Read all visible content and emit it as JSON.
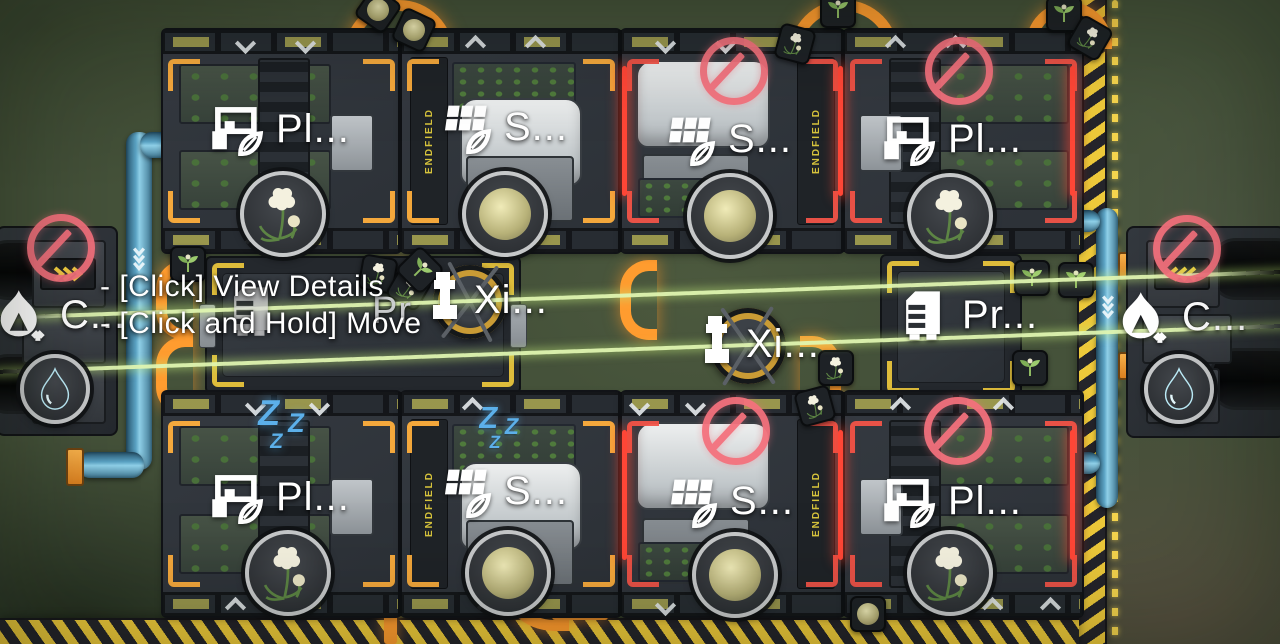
{
  "hud": {
    "tooltip": [
      "- [Click] View Details",
      "- [Click and Hold] Move"
    ],
    "sleep_glyph": "Z"
  },
  "world": {
    "brand_text": "ENDFIELD"
  },
  "buildings": [
    {
      "type": "planter",
      "label": "Pl...",
      "status": "active",
      "output": "flower",
      "position": "top-row-1"
    },
    {
      "type": "seeder",
      "label": "S...",
      "status": "active",
      "output": "seeds",
      "position": "top-row-2"
    },
    {
      "type": "seeder",
      "label": "S...",
      "status": "blocked",
      "output": "seeds",
      "position": "top-row-3"
    },
    {
      "type": "planter",
      "label": "Pl...",
      "status": "blocked",
      "output": "flower",
      "position": "top-row-4"
    },
    {
      "type": "water-collector",
      "label": "C...",
      "status": "blocked",
      "output": "water",
      "position": "left-edge"
    },
    {
      "type": "processor",
      "label": "Pr",
      "status": "hovered",
      "position": "middle-left"
    },
    {
      "type": "xiranite-collector",
      "label": "Xi...",
      "status": "active",
      "position": "middle-center-left"
    },
    {
      "type": "xiranite-collector",
      "label": "Xi...",
      "status": "active",
      "position": "middle-center-right"
    },
    {
      "type": "processor",
      "label": "Pr...",
      "status": "active",
      "position": "middle-right"
    },
    {
      "type": "water-collector",
      "label": "C...",
      "status": "blocked",
      "output": "water",
      "position": "right-edge"
    },
    {
      "type": "planter",
      "label": "Pl...",
      "status": "idle",
      "output": "flower",
      "position": "bottom-row-1"
    },
    {
      "type": "seeder",
      "label": "S...",
      "status": "idle",
      "output": "seeds",
      "position": "bottom-row-2"
    },
    {
      "type": "seeder",
      "label": "S...",
      "status": "blocked",
      "output": "seeds",
      "position": "bottom-row-3"
    },
    {
      "type": "planter",
      "label": "Pl...",
      "status": "blocked",
      "output": "flower",
      "position": "bottom-row-4"
    }
  ],
  "colors": {
    "belt_orange": "#ff9c2f",
    "hazard_yellow": "#edc93a",
    "prohibition_red": "#f4717d",
    "sleep_blue": "#5cb0ea",
    "water_cyan": "#4fd0f4",
    "beam_green": "#daf2a8",
    "brand_yellow": "#d6c33c",
    "label_white": "#ffffff"
  }
}
